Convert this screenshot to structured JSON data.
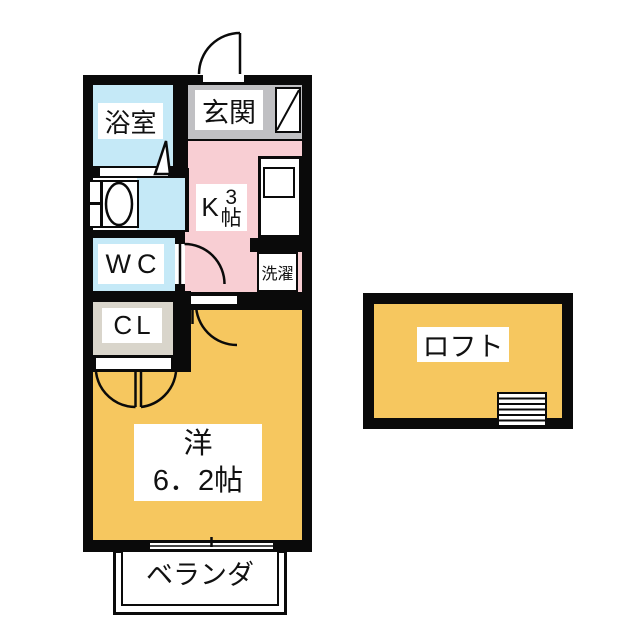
{
  "palette": {
    "wall": "#0a0a0a",
    "orange": "#f6c75f",
    "pink": "#f8ced3",
    "blue": "#c5e9f7",
    "gray": "#c0c0c3",
    "beige": "#d9d5cb",
    "white": "#ffffff"
  },
  "rooms": {
    "bathroom": {
      "label": "浴室"
    },
    "entrance": {
      "label": "玄関"
    },
    "kitchen": {
      "label_k": "K",
      "label_size": "3",
      "label_unit": "帖"
    },
    "wc": {
      "label": "WC"
    },
    "laundry": {
      "label": "洗濯"
    },
    "closet": {
      "label": "CL"
    },
    "main_room": {
      "label": "洋",
      "size": "6．2帖"
    },
    "veranda": {
      "label": "ベランダ"
    },
    "loft": {
      "label": "ロフト"
    }
  }
}
